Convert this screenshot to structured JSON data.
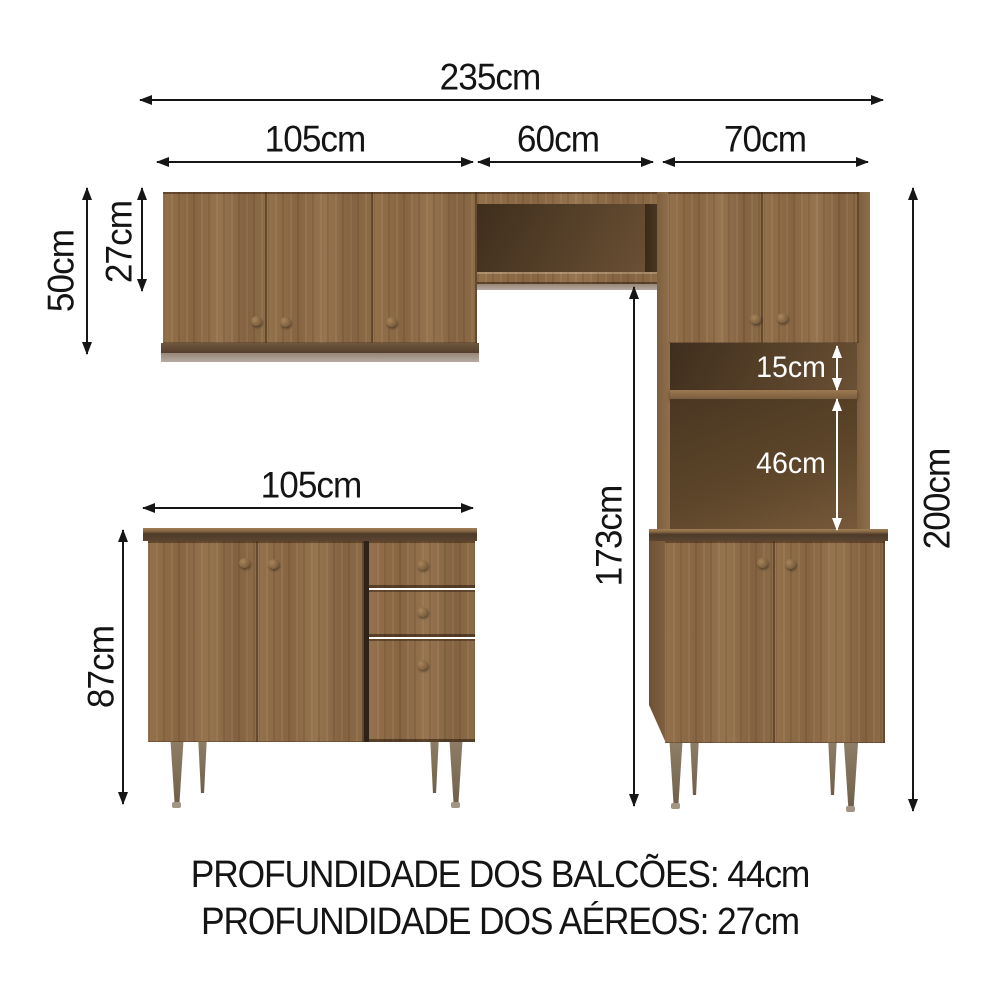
{
  "dims": {
    "total_width": "235cm",
    "aereo_left": "105cm",
    "aereo_center": "60cm",
    "aereo_right": "70cm",
    "aereo_height": "50cm",
    "niche_height": "27cm",
    "balcao_width": "105cm",
    "balcao_height": "87cm",
    "clearance_height": "173cm",
    "total_height": "200cm",
    "shelf_top_gap": "15cm",
    "shelf_bottom_gap": "46cm"
  },
  "footer": {
    "line1": "PROFUNDIDADE DOS BALCÕES: 44cm",
    "line2": "PROFUNDIDADE DOS AÉREOS: 27cm"
  },
  "colors": {
    "wood": "#8e6d48",
    "wood_dark": "#6b523a",
    "interior_dark": "#523d27",
    "board_edge": "#4e3a29",
    "leg": "#86755d",
    "dimension_lines": "#161616",
    "light_labels": "#ffffff",
    "background": "#ffffff"
  }
}
